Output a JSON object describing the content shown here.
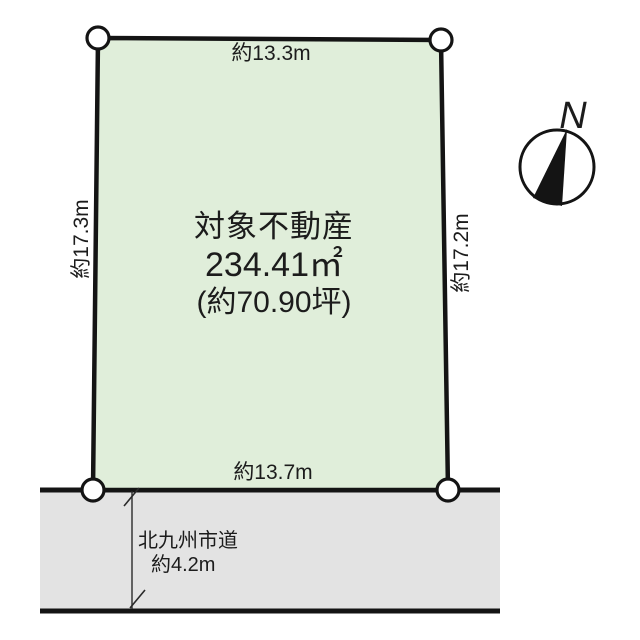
{
  "title": "land-plot-diagram",
  "colors": {
    "background": "#ffffff",
    "plot_fill": "#e0eeda",
    "road_fill": "#e3e3e3",
    "line": "#141414",
    "marker_fill": "#ffffff",
    "text": "#1c1c1c"
  },
  "plot": {
    "label_line1": "対象不動産",
    "label_line2": "234.41㎡",
    "label_line3": "(約70.90坪)"
  },
  "dimensions": {
    "top": "約13.3m",
    "bottom": "約13.7m",
    "left": "約17.3m",
    "right": "約17.2m"
  },
  "road": {
    "name": "北九州市道",
    "width": "約4.2m"
  },
  "compass": {
    "north_label": "N"
  }
}
